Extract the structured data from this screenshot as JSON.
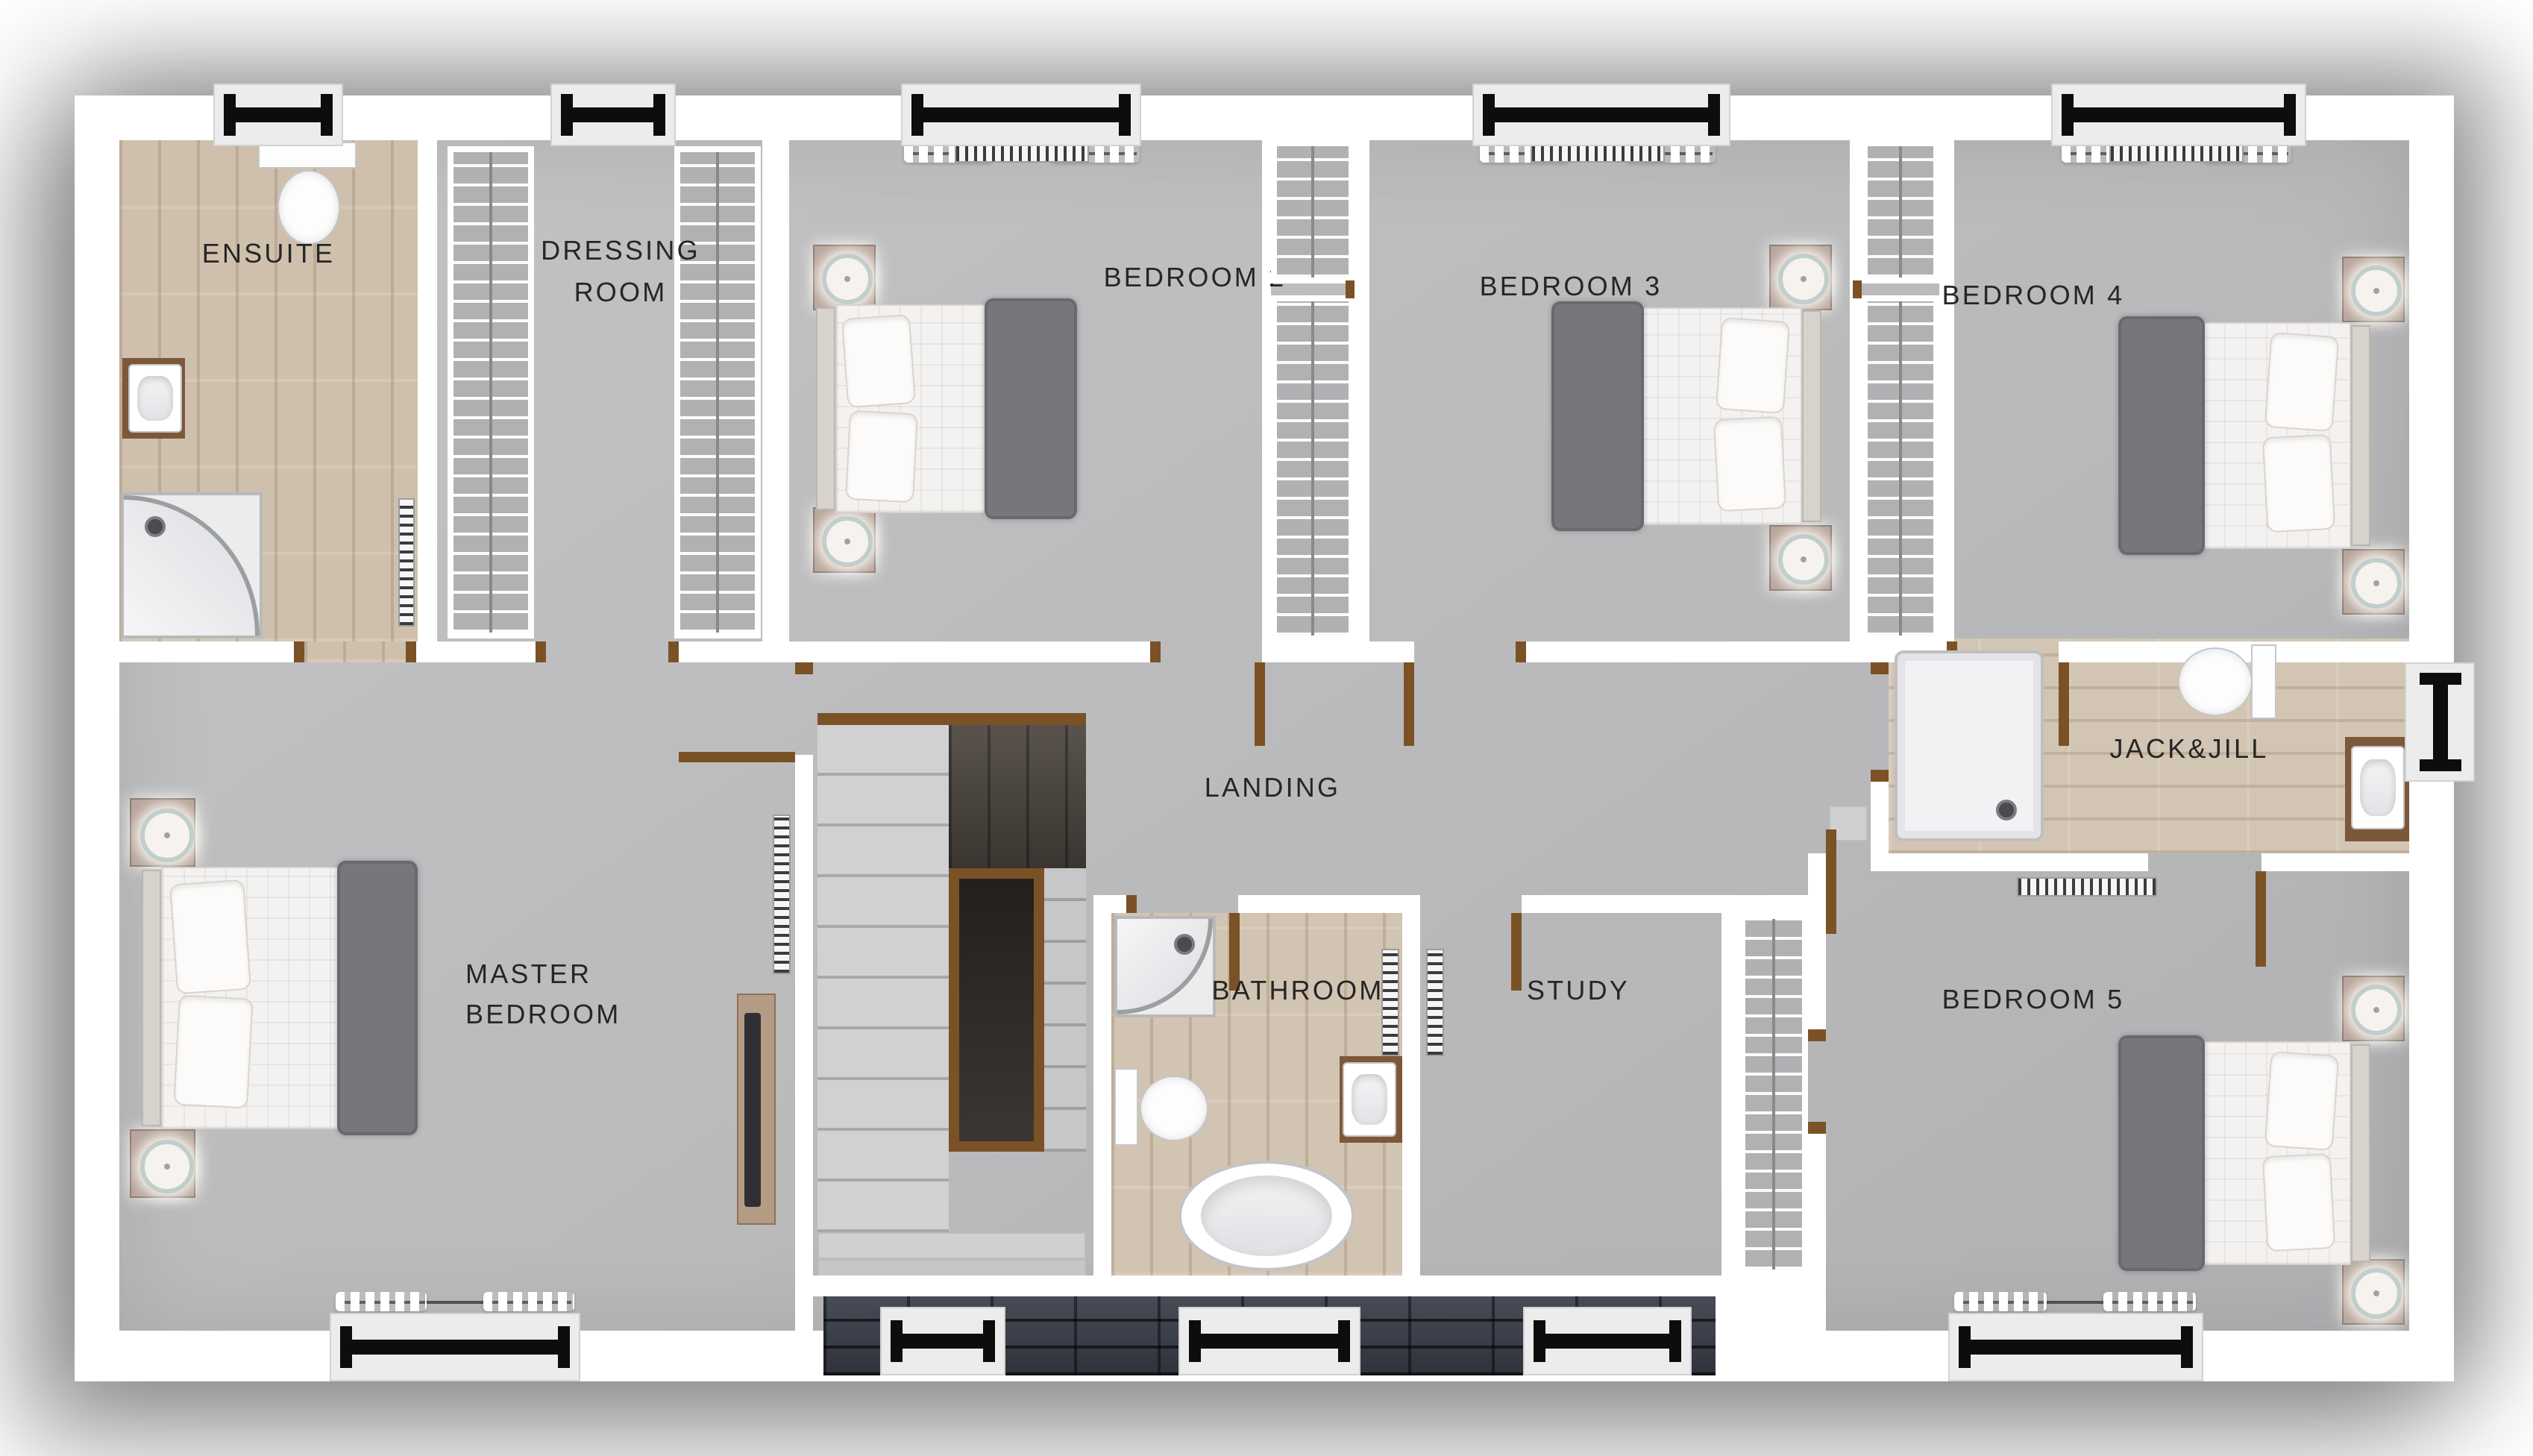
{
  "plan_title": "",
  "rooms": {
    "ensuite": {
      "label": "ENSUITE",
      "floor": "wood",
      "fixtures": [
        "toilet",
        "sink",
        "corner-shower",
        "radiator",
        "window"
      ]
    },
    "dressing_room": {
      "lines": [
        "DRESSING",
        "ROOM"
      ],
      "floor": "carpet",
      "fixtures": [
        "clothes-rail-left",
        "clothes-rail-right",
        "window"
      ]
    },
    "bedroom2": {
      "label": "BEDROOM 2",
      "floor": "carpet",
      "fixtures": [
        "double-bed",
        "nightstand",
        "nightstand",
        "lamp",
        "lamp",
        "radiator",
        "curtains",
        "window",
        "wardrobe"
      ]
    },
    "bedroom3": {
      "label": "BEDROOM 3",
      "floor": "carpet",
      "fixtures": [
        "double-bed",
        "nightstand",
        "nightstand",
        "lamp",
        "lamp",
        "radiator",
        "curtains",
        "window",
        "wardrobe"
      ]
    },
    "bedroom4": {
      "label": "BEDROOM 4",
      "floor": "carpet",
      "fixtures": [
        "double-bed",
        "nightstand",
        "nightstand",
        "lamp",
        "lamp",
        "radiator",
        "curtains",
        "window",
        "wardrobe"
      ]
    },
    "landing": {
      "label": "LANDING",
      "floor": "carpet",
      "fixtures": [
        "staircase",
        "banister"
      ]
    },
    "jack_and_jill": {
      "label": "JACK&JILL",
      "floor": "wood",
      "fixtures": [
        "shower-tray",
        "toilet",
        "sink",
        "window"
      ]
    },
    "master_bedroom": {
      "lines": [
        "MASTER",
        "BEDROOM"
      ],
      "floor": "carpet",
      "fixtures": [
        "double-bed",
        "nightstand",
        "nightstand",
        "lamp",
        "lamp",
        "tv-unit",
        "radiator",
        "curtains",
        "window"
      ]
    },
    "bathroom": {
      "label": "BATHROOM",
      "floor": "wood",
      "fixtures": [
        "corner-shower",
        "toilet",
        "sink",
        "freestanding-bath",
        "radiator",
        "window"
      ]
    },
    "study": {
      "label": "STUDY",
      "floor": "carpet",
      "fixtures": [
        "radiator",
        "window"
      ]
    },
    "bedroom5": {
      "label": "BEDROOM 5",
      "floor": "carpet",
      "fixtures": [
        "double-bed",
        "nightstand",
        "nightstand",
        "lamp",
        "lamp",
        "radiator",
        "curtains",
        "window",
        "wardrobe"
      ]
    }
  },
  "window_count": 11,
  "colors": {
    "wall": "#ffffff",
    "carpet_floor": "#bababc",
    "wood_floor": "#cfc0ad",
    "door": "#7b5226",
    "window_bar": "#0d0d0d",
    "roof_tiles": "#3a3f49",
    "bed_throw": "#77777b",
    "stair_well": "#2e2a27",
    "stair_landing_wood": "#4b443e",
    "label_text": "#262626"
  }
}
